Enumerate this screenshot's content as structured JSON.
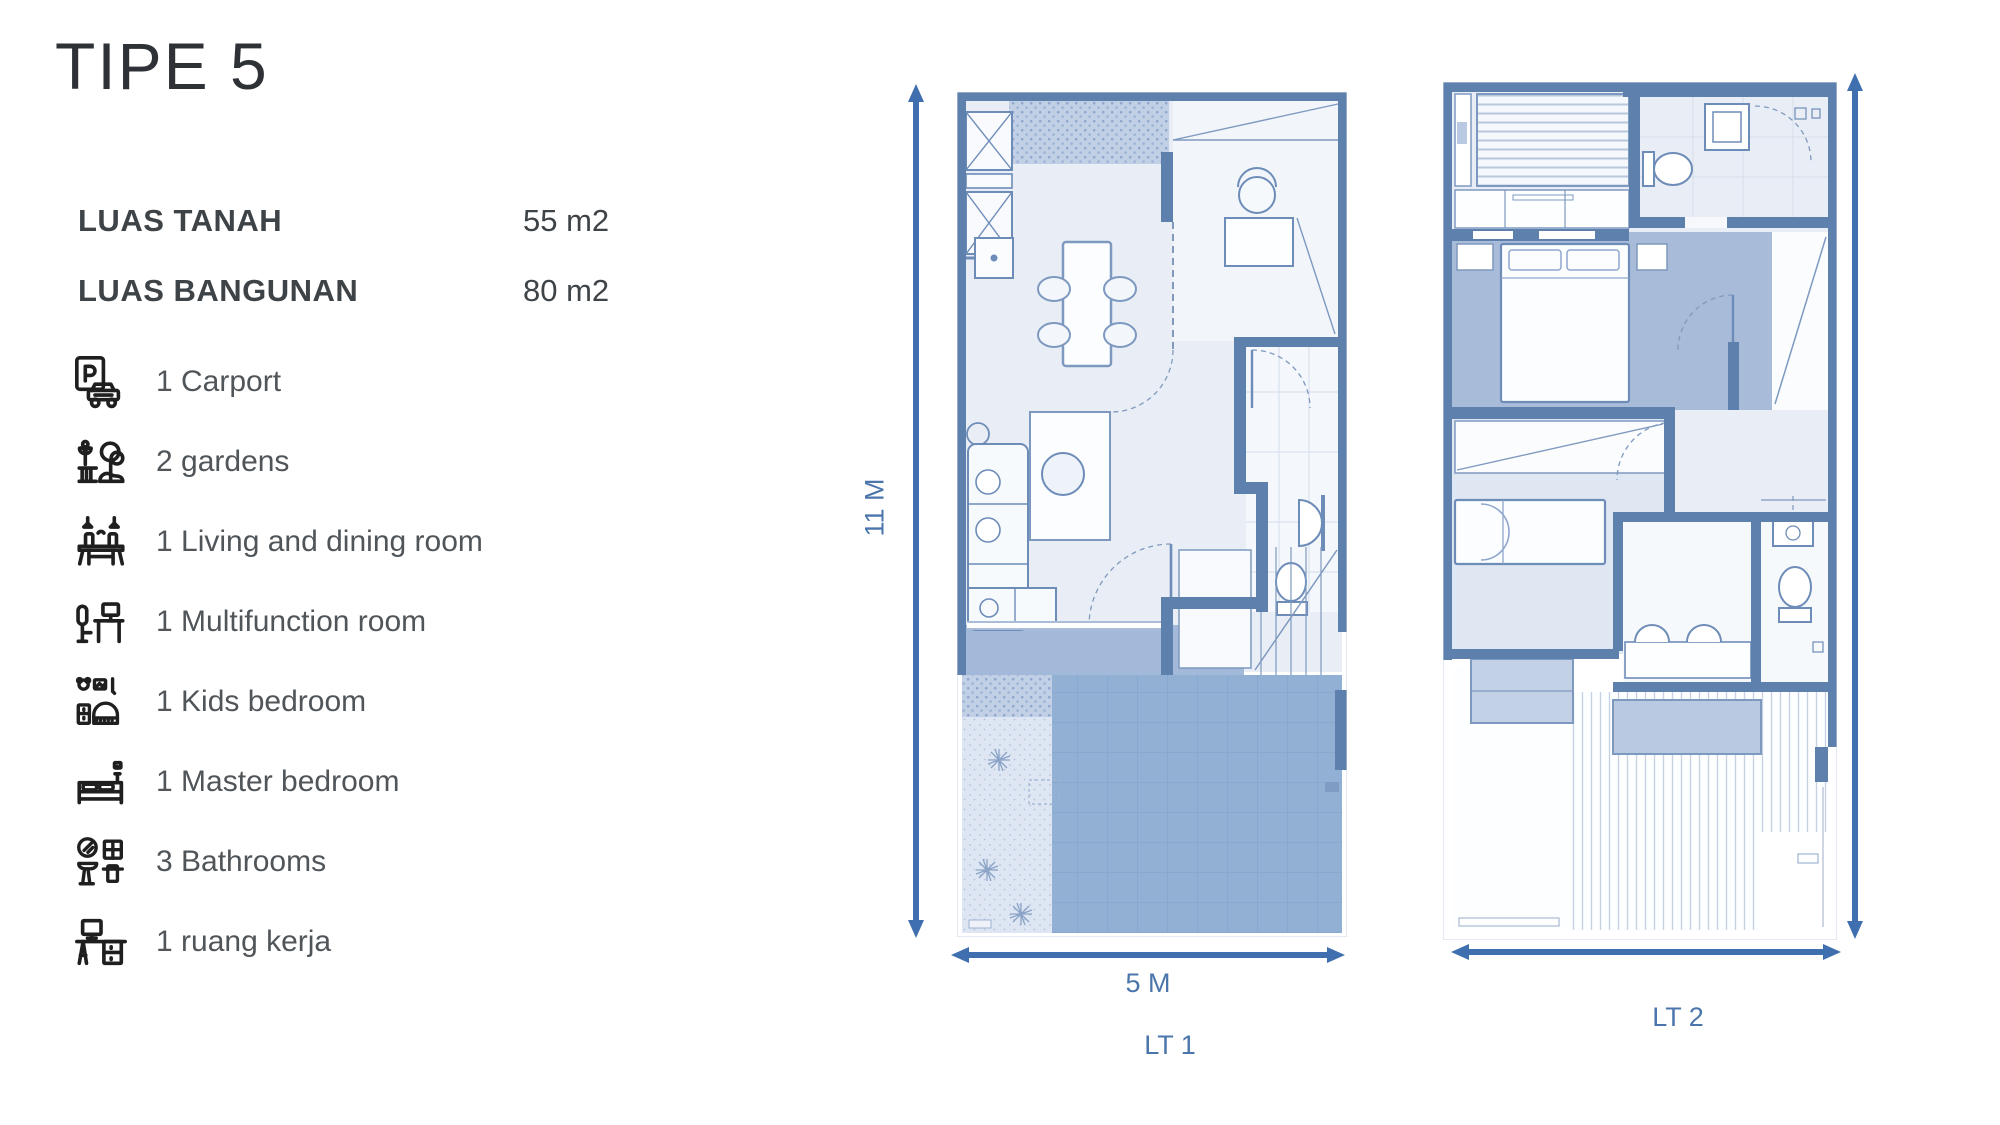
{
  "title": "TIPE 5",
  "specs": [
    {
      "label": "LUAS TANAH",
      "value": "55 m2"
    },
    {
      "label": "LUAS BANGUNAN",
      "value": "80 m2"
    }
  ],
  "features": [
    {
      "icon": "carport-icon",
      "label": "1 Carport"
    },
    {
      "icon": "garden-icon",
      "label": "2 gardens"
    },
    {
      "icon": "dining-icon",
      "label": "1 Living and dining room"
    },
    {
      "icon": "multifunction-icon",
      "label": "1 Multifunction room"
    },
    {
      "icon": "kids-bedroom-icon",
      "label": "1 Kids bedroom"
    },
    {
      "icon": "master-bedroom-icon",
      "label": "1 Master bedroom"
    },
    {
      "icon": "bathroom-icon",
      "label": "3 Bathrooms"
    },
    {
      "icon": "workspace-icon",
      "label": "1 ruang kerja"
    }
  ],
  "floor_plans": [
    {
      "id": "lt1",
      "label": "LT 1",
      "width_dim": "5 M",
      "height_dim": "11 M"
    },
    {
      "id": "lt2",
      "label": "LT 2"
    }
  ],
  "colors": {
    "accent_arrow": "#3f6fae",
    "accent_label": "#4b76ac",
    "wall": "#5e80ad",
    "floor": "#e9eef6",
    "terrace": "#a3b9d9",
    "carport": "#92b0d4",
    "text_dark": "#2e3236",
    "text_gray": "#50555a"
  }
}
